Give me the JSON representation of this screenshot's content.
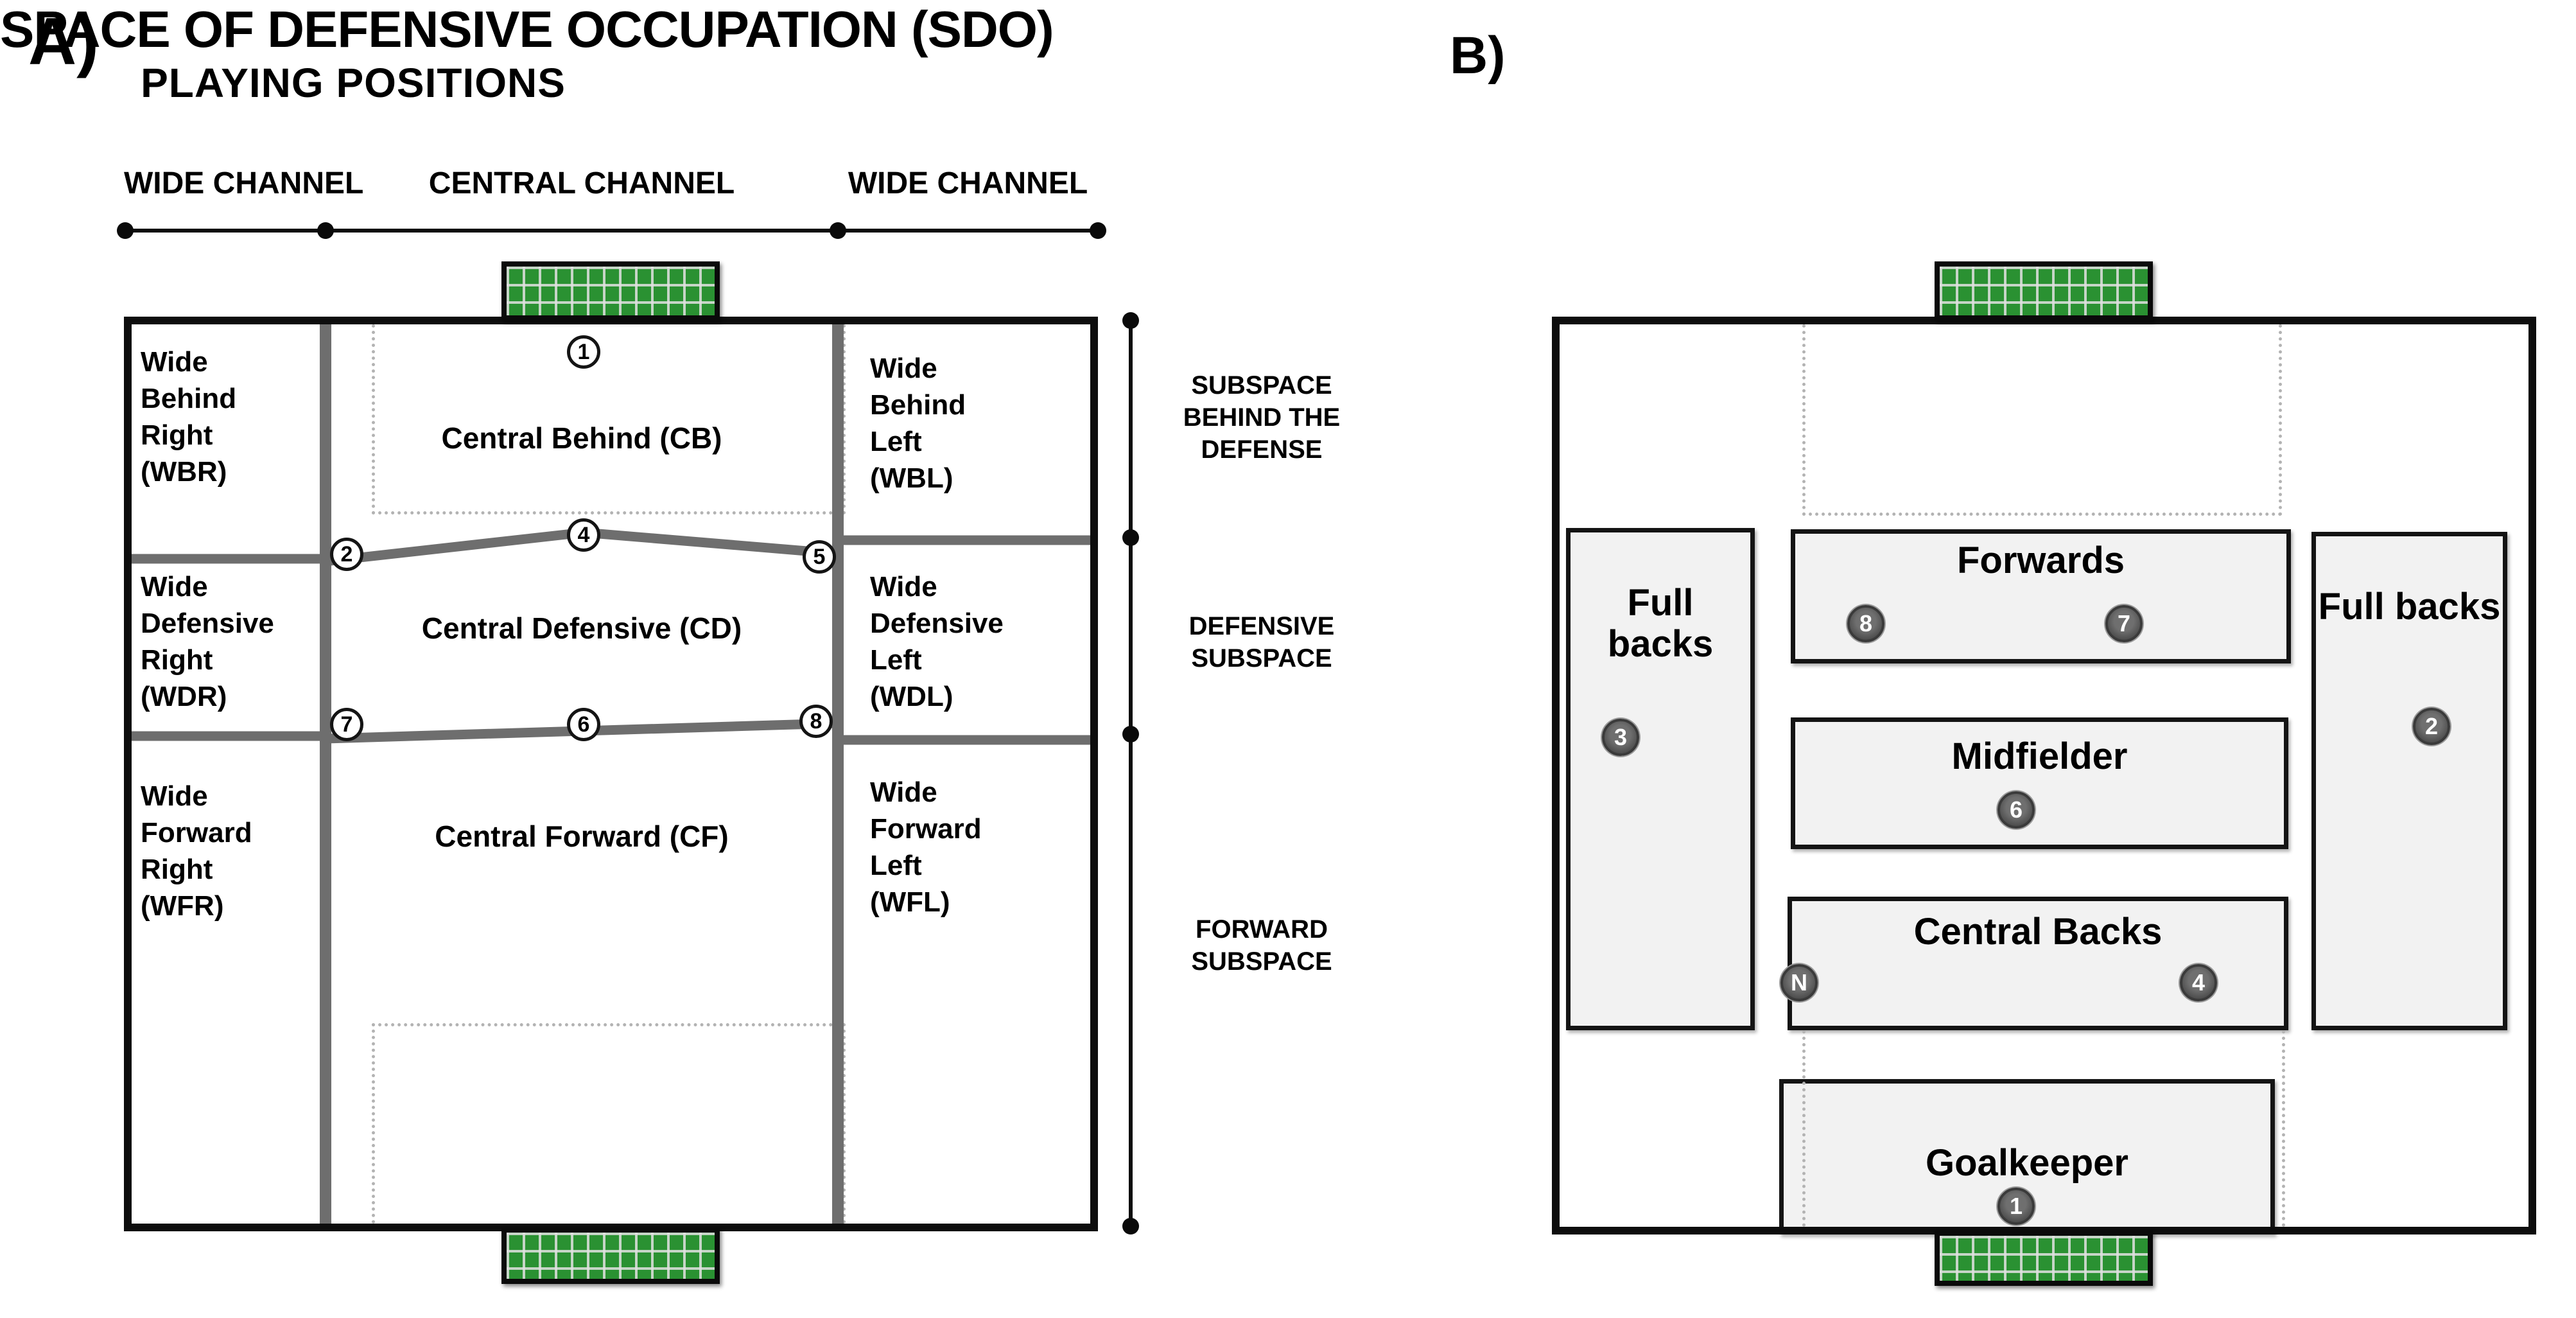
{
  "panel_a": {
    "label": "A)",
    "title": "SPACE OF DEFENSIVE OCCUPATION (SDO)",
    "channel_labels": [
      "WIDE CHANNEL",
      "CENTRAL CHANNEL",
      "WIDE CHANNEL"
    ],
    "zones": {
      "wbr": [
        "Wide",
        "Behind",
        "Right",
        "(WBR)"
      ],
      "wdr": [
        "Wide",
        "Defensive",
        "Right",
        "(WDR)"
      ],
      "wfr": [
        "Wide",
        "Forward",
        "Right",
        "(WFR)"
      ],
      "cb": "Central Behind (CB)",
      "cd": "Central Defensive (CD)",
      "cf": "Central Forward (CF)",
      "wbl": [
        "Wide",
        "Behind",
        "Left",
        "(WBL)"
      ],
      "wdl": [
        "Wide",
        "Defensive",
        "Left",
        "(WDL)"
      ],
      "wfl": [
        "Wide",
        "Forward",
        "Left",
        "(WFL)"
      ]
    },
    "markers": {
      "m1": "1",
      "m2": "2",
      "m4": "4",
      "m5": "5",
      "m6": "6",
      "m7": "7",
      "m8": "8"
    },
    "subspace_labels": [
      "SUBSPACE BEHIND THE DEFENSE",
      "DEFENSIVE SUBSPACE",
      "FORWARD SUBSPACE"
    ]
  },
  "panel_b": {
    "label": "B)",
    "title": "PLAYING POSITIONS",
    "positions": {
      "fullbacks_left": {
        "label": "Full backs",
        "badge": "3"
      },
      "fullbacks_right": {
        "label": "Full backs",
        "badge": "2"
      },
      "forwards": {
        "label": "Forwards",
        "badge_left": "8",
        "badge_right": "7"
      },
      "midfielder": {
        "label": "Midfielder",
        "badge": "6"
      },
      "central_backs": {
        "label": "Central Backs",
        "badge_left": "N",
        "badge_right": "4"
      },
      "goalkeeper": {
        "label": "Goalkeeper",
        "badge": "1"
      }
    }
  },
  "colors": {
    "goal_green": "#2a9132",
    "pitch_line_gray": "#6e6e6e",
    "position_box_fill": "#f2f2f2",
    "badge_fill": "#555555",
    "marker_fill": "#ffffff",
    "dotted_line": "#b3b3b3",
    "border_black": "#0d0d0d"
  }
}
